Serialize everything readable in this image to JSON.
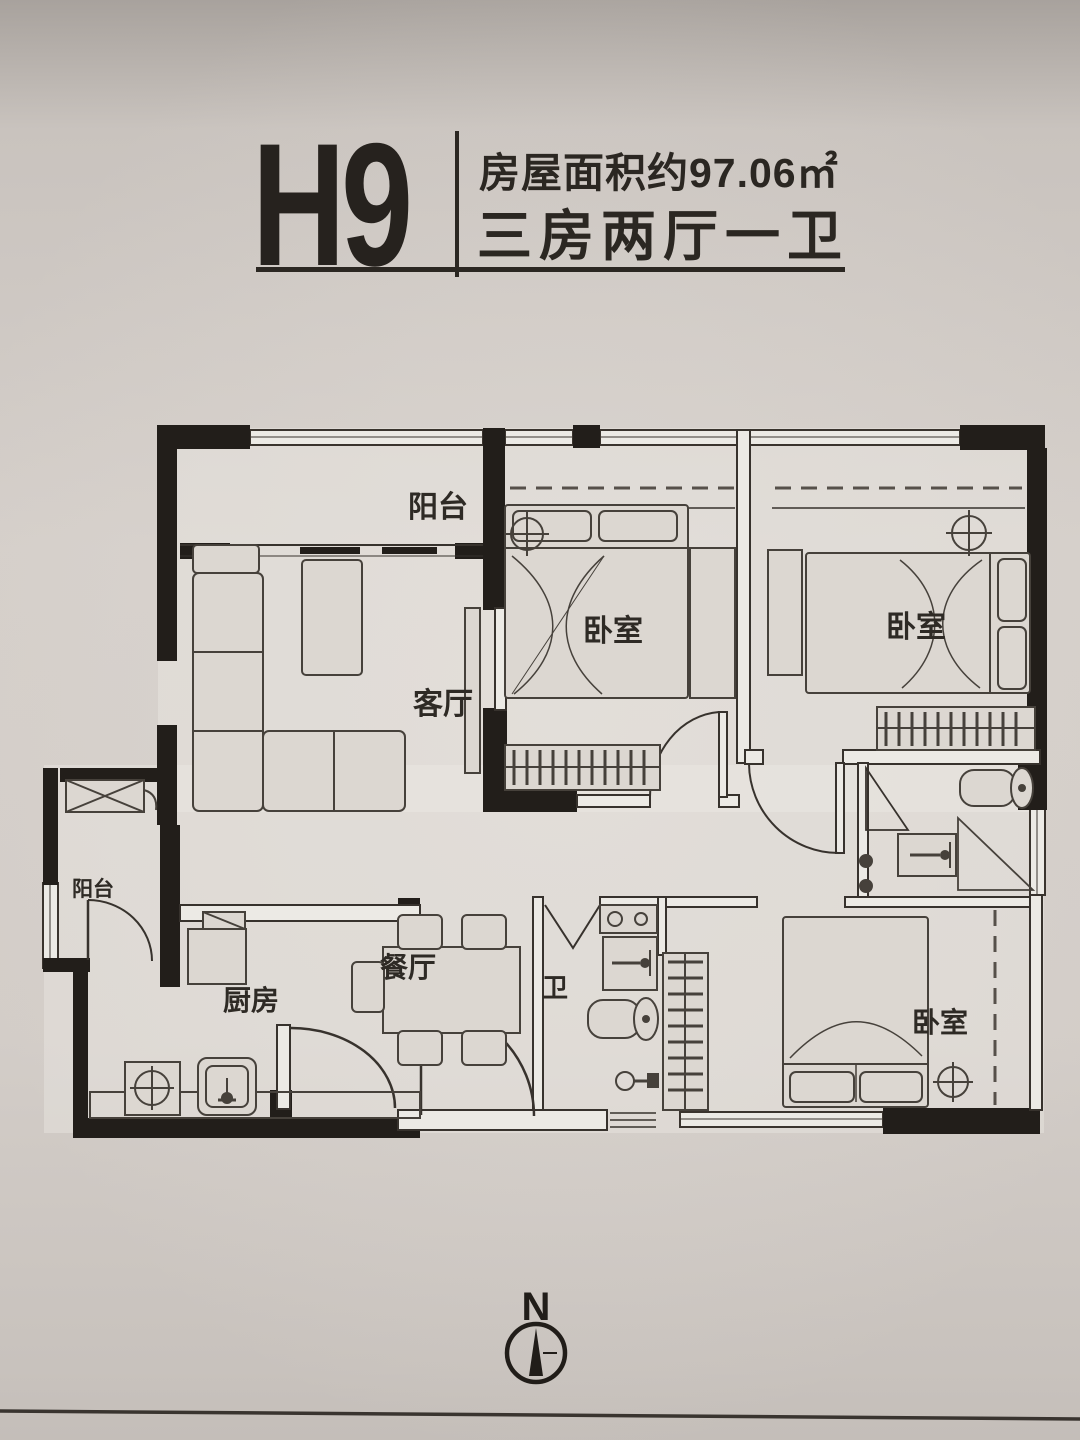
{
  "header": {
    "unit": "H9",
    "area_line": "房屋面积约97.06㎡",
    "layout_line": "三房两厅一卫"
  },
  "rooms": {
    "balcony_top": "阳台",
    "living": "客厅",
    "bedroom1": "卧室",
    "bedroom2": "卧室",
    "bedroom3": "卧室",
    "balcony_left": "阳台",
    "kitchen": "厨房",
    "dining": "餐厅",
    "bath": "卫"
  },
  "compass": {
    "label": "N"
  },
  "colors": {
    "ink": "#26221e",
    "wall": "#221e1a",
    "thin_line": "#3a342e",
    "paper": "#d2ccc7"
  }
}
